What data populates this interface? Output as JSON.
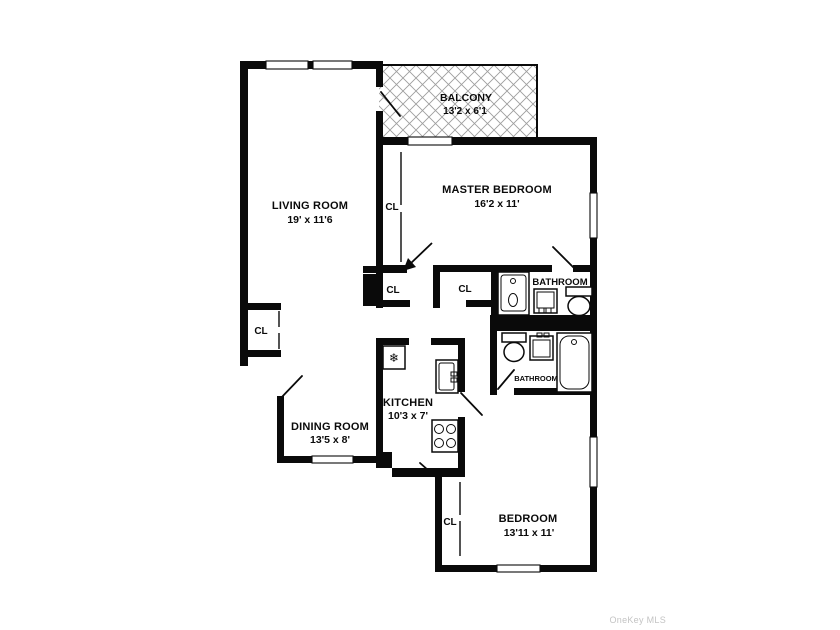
{
  "title": "Apartment floor plan",
  "colors": {
    "background": "#ffffff",
    "wall": "#0a0a0a",
    "text": "#0a0a0a",
    "hatch": "#9e9e9e",
    "watermark": "#c4c4c4"
  },
  "rooms": {
    "balcony": {
      "name": "BALCONY",
      "dims": "13'2 x 6'1"
    },
    "living_room": {
      "name": "LIVING ROOM",
      "dims": "19' x 11'6"
    },
    "master_bedroom": {
      "name": "MASTER BEDROOM",
      "dims": "16'2 x 11'"
    },
    "dining_room": {
      "name": "DINING ROOM",
      "dims": "13'5 x 8'"
    },
    "kitchen": {
      "name": "KITCHEN",
      "dims": "10'3 x 7'"
    },
    "bedroom": {
      "name": "BEDROOM",
      "dims": "13'11 x 11'"
    },
    "bathroom_upper": {
      "name": "BATHROOM"
    },
    "bathroom_lower": {
      "name": "BATHROOM"
    }
  },
  "closet_label": "CL",
  "icons": {
    "refrigerator_glyph": "❄"
  },
  "watermark": {
    "text": "OneKey MLS"
  }
}
